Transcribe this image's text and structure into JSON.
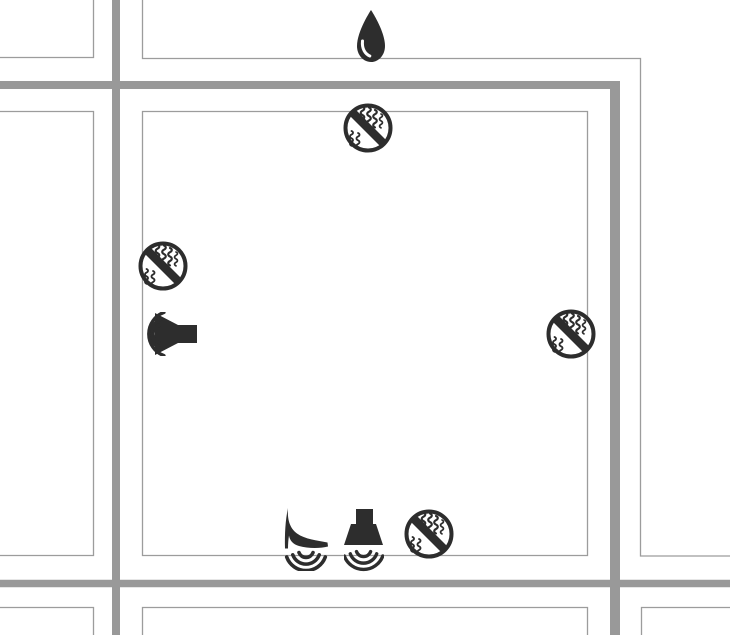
{
  "title": "Street map with noise and vibration markers",
  "colors": {
    "background": "#ffffff",
    "street": "#999999",
    "block_border": "#9c9c9c",
    "icon": "#2d2d2d",
    "icon_bg": "#ffffff"
  },
  "markers": {
    "water_drop": {
      "label": "water drop"
    },
    "no_vibration_top": {
      "label": "no vibration zone (top edge of block)"
    },
    "no_vibration_left": {
      "label": "no vibration zone (left edge of block)"
    },
    "no_vibration_right": {
      "label": "no vibration zone (right edge of block)"
    },
    "no_vibration_bottom": {
      "label": "no vibration zone (bottom edge of block)"
    },
    "loudspeaker": {
      "label": "loudspeaker noise source"
    },
    "high_heel": {
      "label": "high-heel footstep vibration source"
    },
    "hood_speaker": {
      "label": "downward speaker vibration source"
    }
  }
}
